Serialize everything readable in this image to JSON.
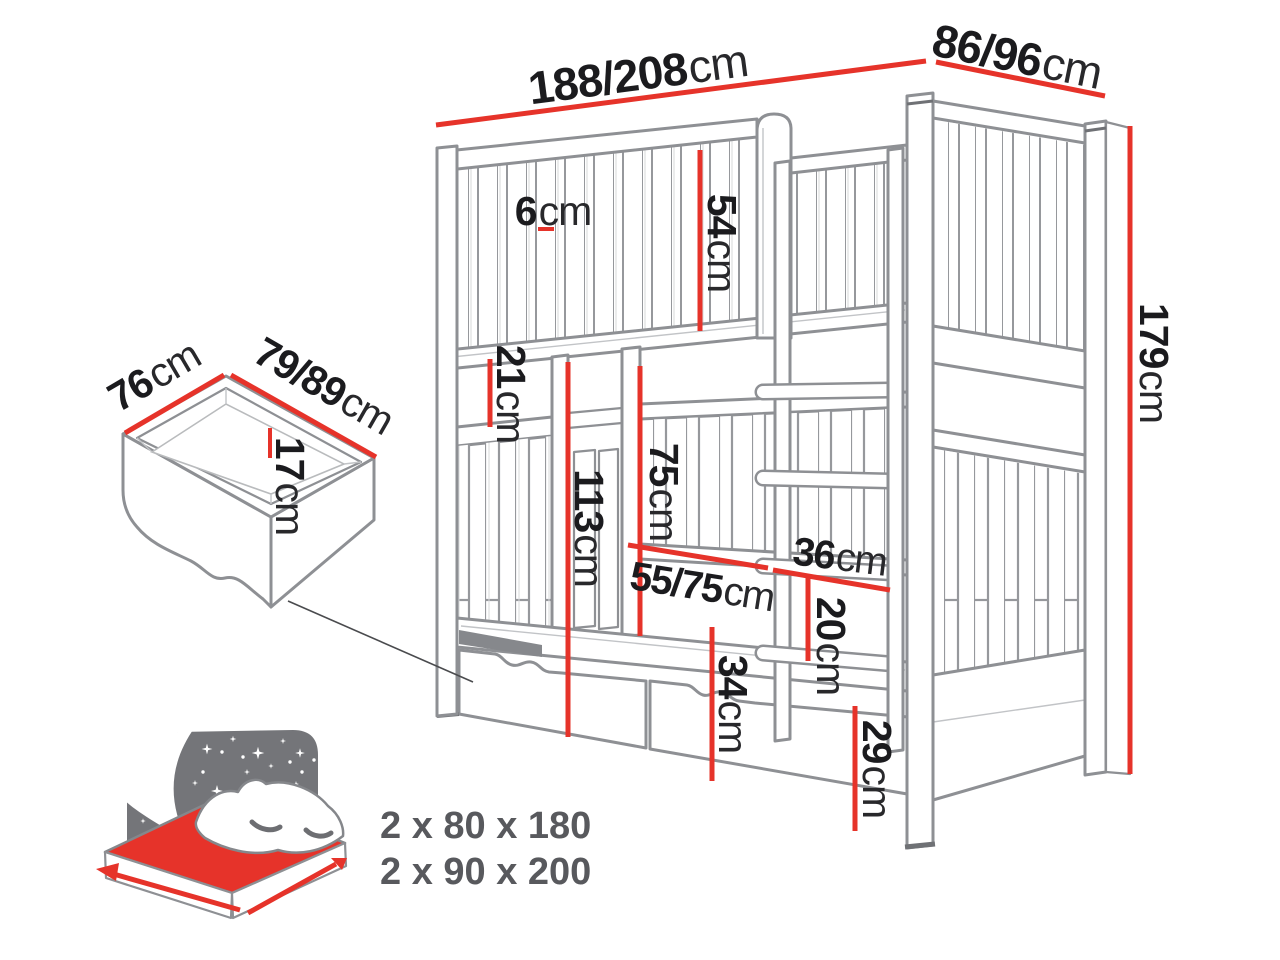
{
  "diagram": {
    "subject": "bunk-bed-with-storage-drawers-dimension-diagram",
    "unit": "cm"
  },
  "dimensions": {
    "bed_length_top": {
      "value": "188/208",
      "unit": "cm"
    },
    "bed_depth_top": {
      "value": "86/96",
      "unit": "cm"
    },
    "slat_gap": {
      "value": "6",
      "unit": "cm"
    },
    "upper_guard_height": {
      "value": "54",
      "unit": "cm"
    },
    "bunk_gap": {
      "value": "21",
      "unit": "cm"
    },
    "upper_bunk_underside": {
      "value": "113",
      "unit": "cm"
    },
    "entry_opening_height": {
      "value": "75",
      "unit": "cm"
    },
    "entry_opening_width": {
      "value": "55/75",
      "unit": "cm"
    },
    "ladder_width": {
      "value": "36",
      "unit": "cm"
    },
    "ladder_rung_spacing": {
      "value": "20",
      "unit": "cm"
    },
    "drawer_front_height": {
      "value": "34",
      "unit": "cm"
    },
    "base_height": {
      "value": "29",
      "unit": "cm"
    },
    "total_height": {
      "value": "179",
      "unit": "cm"
    },
    "drawer_depth": {
      "value": "76",
      "unit": "cm"
    },
    "drawer_length": {
      "value": "79/89",
      "unit": "cm"
    },
    "drawer_inner_height": {
      "value": "17",
      "unit": "cm"
    }
  },
  "mattress_info": {
    "line1": "2 x 80 x 180",
    "line2": "2 x 90 x 200"
  },
  "colors": {
    "dimension_red": "#e6332a",
    "line_gray": "#8e9094",
    "headboard_gray": "#747579",
    "text_black": "#1b1b1e",
    "text_gray": "#58595d"
  }
}
